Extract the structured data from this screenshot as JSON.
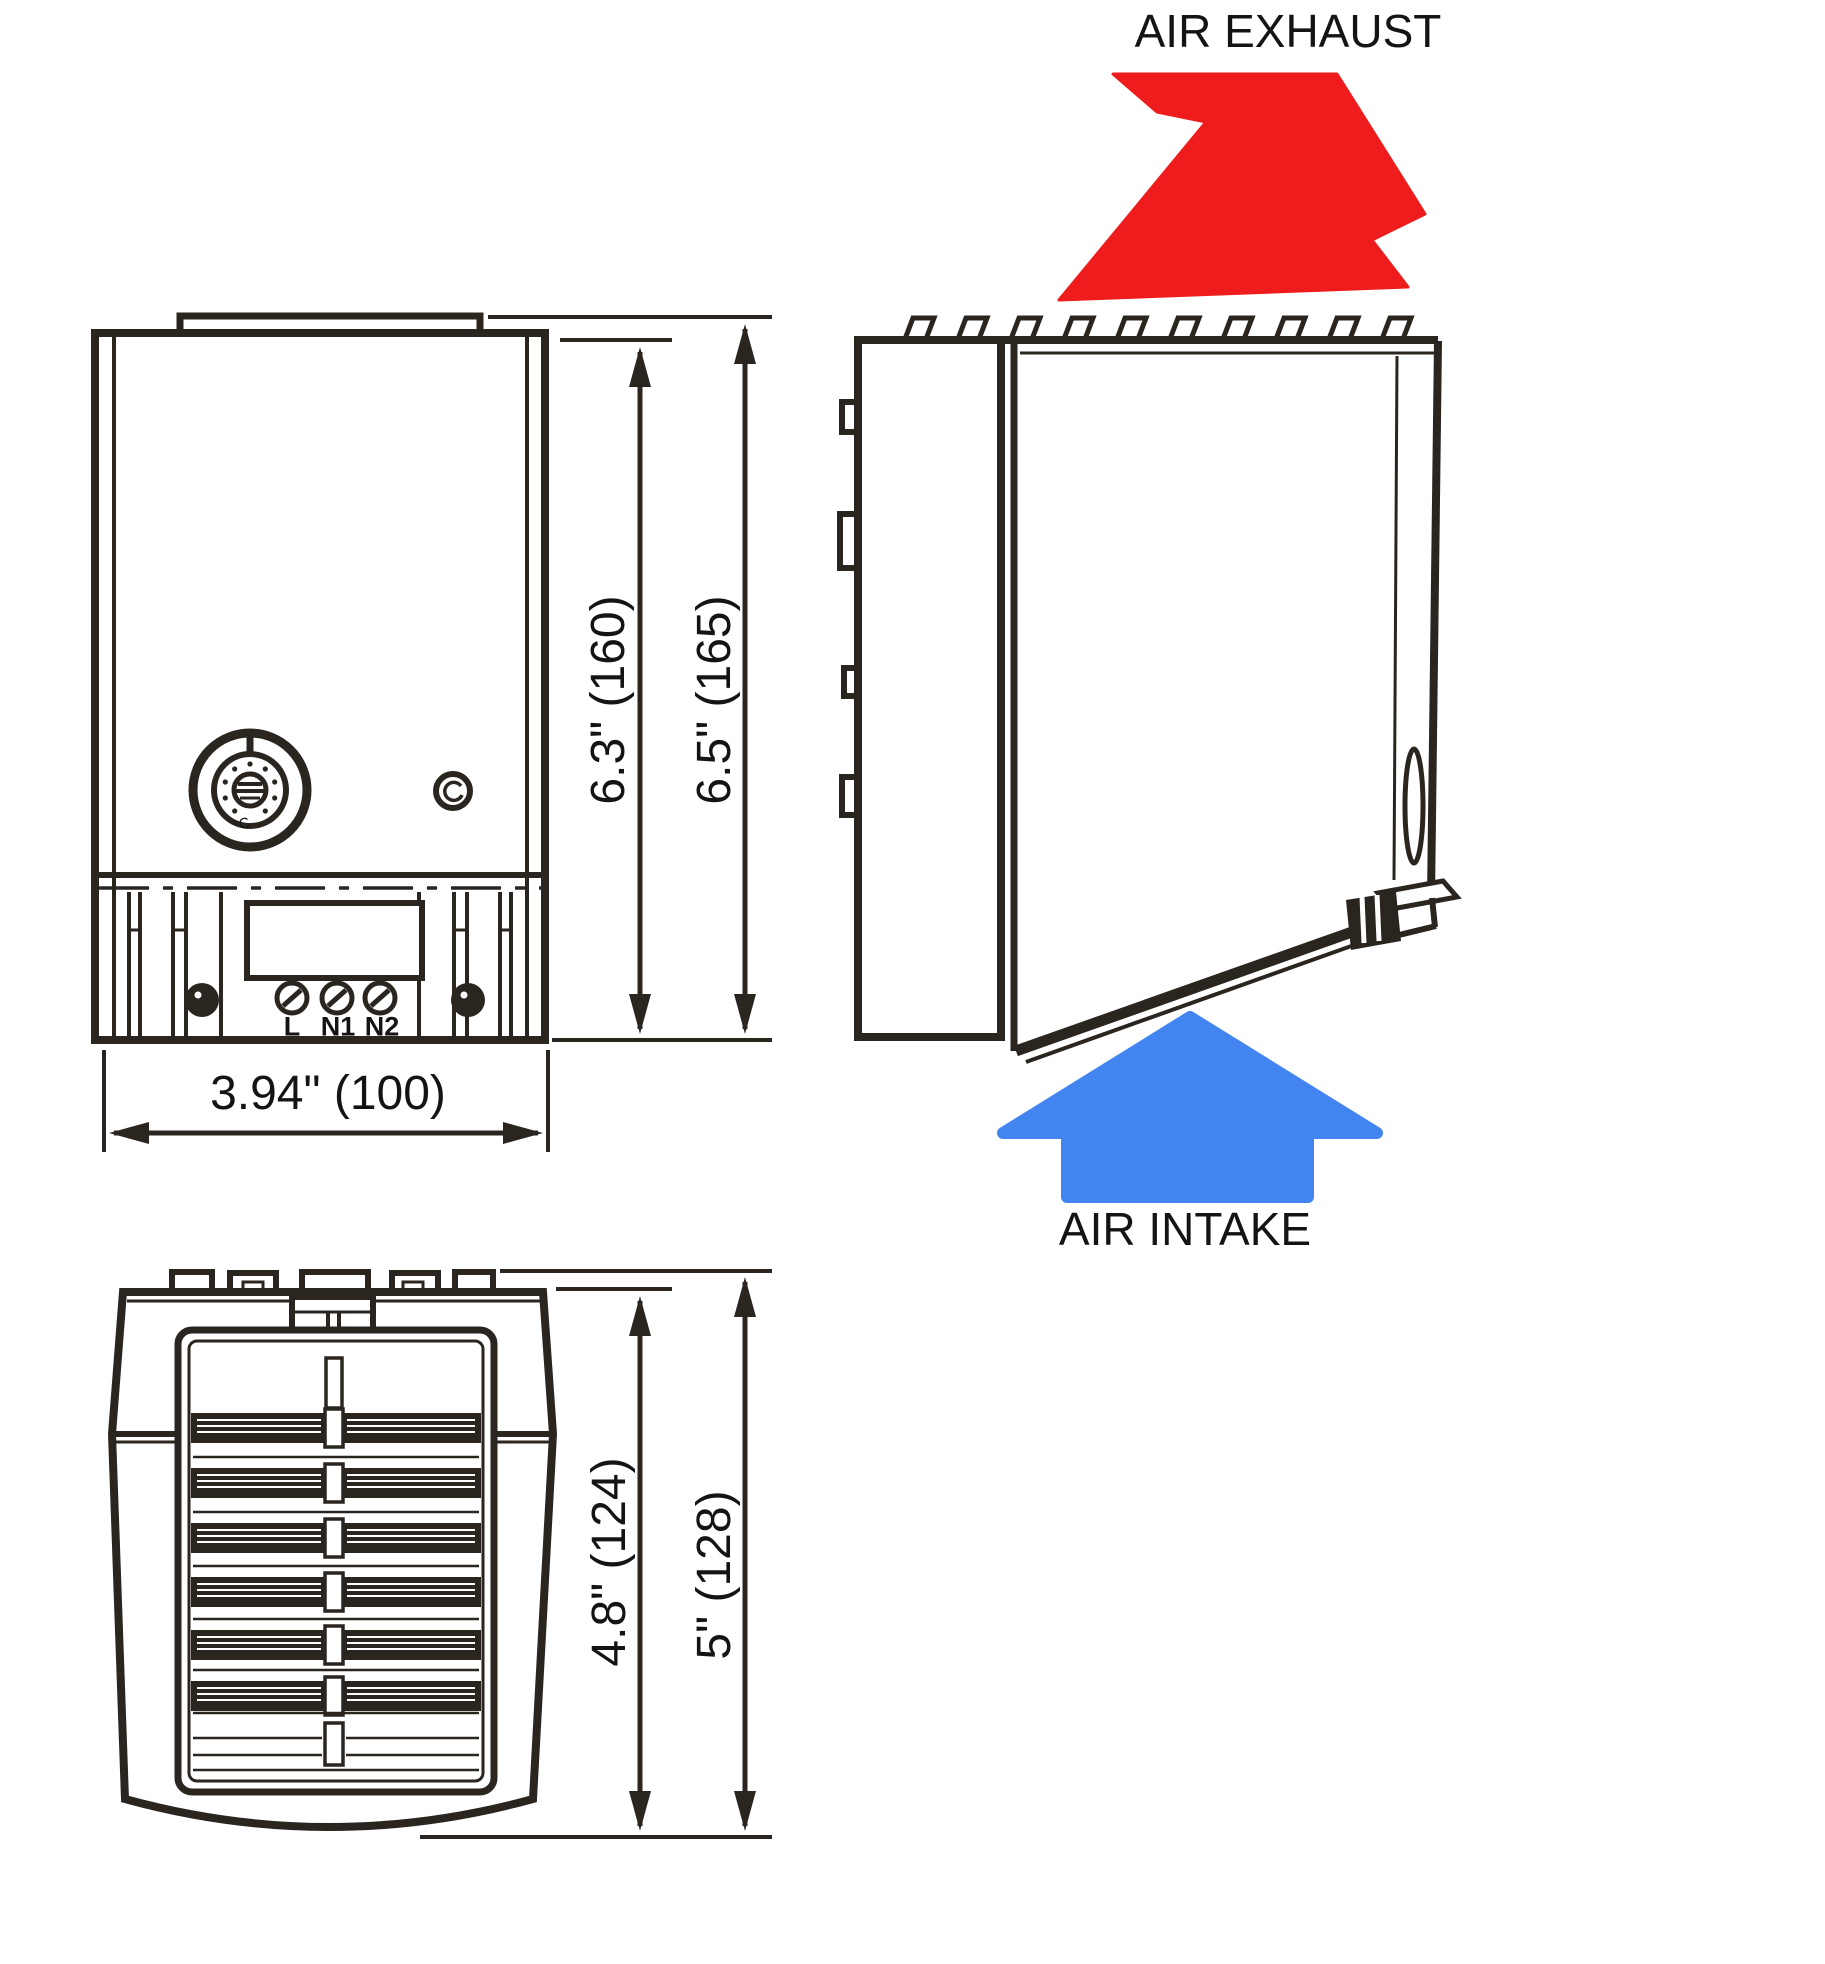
{
  "page": {
    "background": "#ffffff"
  },
  "colors": {
    "exhaust_arrow": "#ee1c1c",
    "intake_arrow": "#4385f0",
    "line": "#2b2520"
  },
  "airflow": {
    "exhaust_label": "AIR EXHAUST",
    "intake_label": "AIR INTAKE"
  },
  "front_view": {
    "height_body": "6.3\" (160)",
    "height_overall": "6.5\" (165)",
    "width_overall": "3.94\" (100)",
    "terminal_labels": [
      "L",
      "N1",
      "N2"
    ],
    "dial_unit": "°C"
  },
  "top_view": {
    "depth_body": "4.8\" (124)",
    "depth_overall": "5\" (128)"
  }
}
